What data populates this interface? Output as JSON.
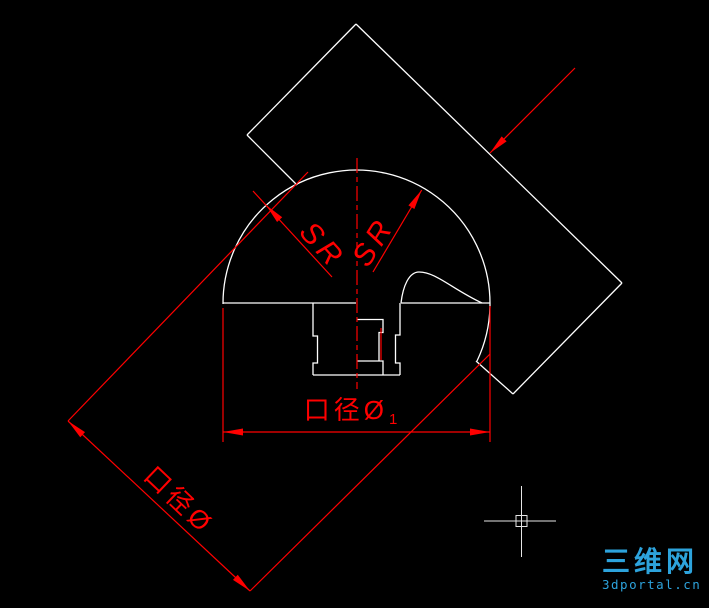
{
  "canvas": {
    "width": 709,
    "height": 608,
    "background": "#000000"
  },
  "colors": {
    "geometry": "#ffffff",
    "dimension": "#ff0000",
    "crosshair": "#e6e6e6",
    "watermark": "#2da3dc"
  },
  "labels": {
    "sr_left": "SR",
    "sr_right": "SR",
    "aperture_diagonal": "口径Ø",
    "aperture_horizontal": "口径Ø",
    "aperture_horizontal_sub": "1",
    "watermark_cn": "三维网",
    "watermark_url": "3dportal.cn"
  },
  "text_placement": {
    "sr_left": {
      "x": 322,
      "y": 246,
      "rotate": 48
    },
    "sr_right": {
      "x": 374,
      "y": 242,
      "rotate": -58
    },
    "aperture_diagonal": {
      "x": 179,
      "y": 500,
      "rotate": 43.5
    },
    "aperture_horizontal": {
      "x": 352,
      "y": 410,
      "rotate": 0
    }
  },
  "geometry": {
    "white": {
      "dome_arc": {
        "cx": 356.5,
        "cy": 304,
        "r": 133.5,
        "path": "M 223,304 A 133.5 133.5 0 1 1 477,361"
      },
      "lines": [
        {
          "name": "dome-base-line-left",
          "x1": 223,
          "y1": 303,
          "x2": 356,
          "y2": 303
        },
        {
          "name": "dome-base-line-right",
          "x1": 401,
          "y1": 303,
          "x2": 489.5,
          "y2": 303
        },
        {
          "name": "plate-edge-upper-left",
          "x1": 247,
          "y1": 135,
          "x2": 356,
          "y2": 24
        },
        {
          "name": "plate-edge-upper-right",
          "x1": 356,
          "y1": 24,
          "x2": 622,
          "y2": 283
        },
        {
          "name": "plate-edge-lower-right",
          "x1": 622,
          "y1": 283,
          "x2": 513,
          "y2": 394
        },
        {
          "name": "plate-edge-lower-left-a",
          "x1": 247,
          "y1": 135,
          "x2": 297,
          "y2": 185
        },
        {
          "name": "plate-edge-lower-left-b",
          "x1": 476,
          "y1": 361,
          "x2": 513,
          "y2": 394
        },
        {
          "name": "stem-bottom-line",
          "x1": 313,
          "y1": 375,
          "x2": 400,
          "y2": 375
        }
      ],
      "paths": [
        {
          "name": "stem-left-profile",
          "d": "M 313,303 L 313,336 L 317.5,336 L 317.5,363 L 313,363 L 313,375"
        },
        {
          "name": "stem-right-profile",
          "d": "M 400,303 L 400,335 L 395.5,335 L 395.5,363 L 400,363 L 400,375"
        },
        {
          "name": "bore-counterbore",
          "d": "M 357,319.5 L 383,319.5 L 383,332.5 L 379,332.5 L 379,361"
        },
        {
          "name": "bore-lower-step",
          "d": "M 357,361 L 383,361 L 383,375"
        },
        {
          "name": "cavity-curve",
          "d": "M 401,303 C 403,286 409,272 419,272 C 436,272 452,289 482,303"
        }
      ]
    },
    "red": {
      "centerline": {
        "name": "vertical-centerline",
        "x": 357,
        "y1": 158,
        "y2": 389,
        "dash": "15,4,5,4"
      },
      "lines": [
        {
          "name": "sr-left-radius-line",
          "x1": 332,
          "y1": 277,
          "x2": 253,
          "y2": 191
        },
        {
          "name": "sr-right-radius-line",
          "x1": 373,
          "y1": 272,
          "x2": 421.7,
          "y2": 190
        },
        {
          "name": "leader-line",
          "x1": 575,
          "y1": 68,
          "x2": 490,
          "y2": 153
        },
        {
          "name": "dim-diagonal-line",
          "x1": 68,
          "y1": 421,
          "x2": 250,
          "y2": 591
        },
        {
          "name": "dim-diagonal-ext-left",
          "x1": 68,
          "y1": 421,
          "x2": 308,
          "y2": 172
        },
        {
          "name": "dim-diagonal-ext-right",
          "x1": 250,
          "y1": 591,
          "x2": 490,
          "y2": 354
        },
        {
          "name": "dim-horizontal-line",
          "x1": 223,
          "y1": 432,
          "x2": 490,
          "y2": 432
        },
        {
          "name": "dim-horizontal-ext-left",
          "x1": 223,
          "y1": 308,
          "x2": 223,
          "y2": 442
        },
        {
          "name": "dim-horizontal-ext-right",
          "x1": 490,
          "y1": 306,
          "x2": 490,
          "y2": 442
        },
        {
          "name": "bore-contact-line",
          "x1": 381,
          "y1": 328,
          "x2": 381,
          "y2": 360
        }
      ],
      "arrows": [
        {
          "name": "sr-left-arrowhead",
          "x": 266,
          "y": 205,
          "angle": 227
        },
        {
          "name": "sr-right-arrowhead",
          "x": 421.7,
          "y": 190,
          "angle": -59
        },
        {
          "name": "leader-arrowhead",
          "x": 490,
          "y": 153,
          "angle": 135
        },
        {
          "name": "dim-diagonal-arrowhead-1",
          "x": 68,
          "y": 421,
          "angle": 223
        },
        {
          "name": "dim-diagonal-arrowhead-2",
          "x": 250,
          "y": 591,
          "angle": 43
        },
        {
          "name": "dim-horizontal-arrowhead-left",
          "x": 223,
          "y": 432,
          "angle": 180
        },
        {
          "name": "dim-horizontal-arrowhead-right",
          "x": 490,
          "y": 432,
          "angle": 0
        }
      ],
      "arrow_size": {
        "length": 20,
        "half_width": 3.5
      }
    },
    "crosshair": {
      "cx": 521.5,
      "cy": 521,
      "h": {
        "x1": 484,
        "x2": 556
      },
      "v": {
        "y1": 486,
        "y2": 557
      },
      "pickbox": {
        "x": 516,
        "y": 515.5,
        "w": 11,
        "h": 11
      }
    }
  }
}
